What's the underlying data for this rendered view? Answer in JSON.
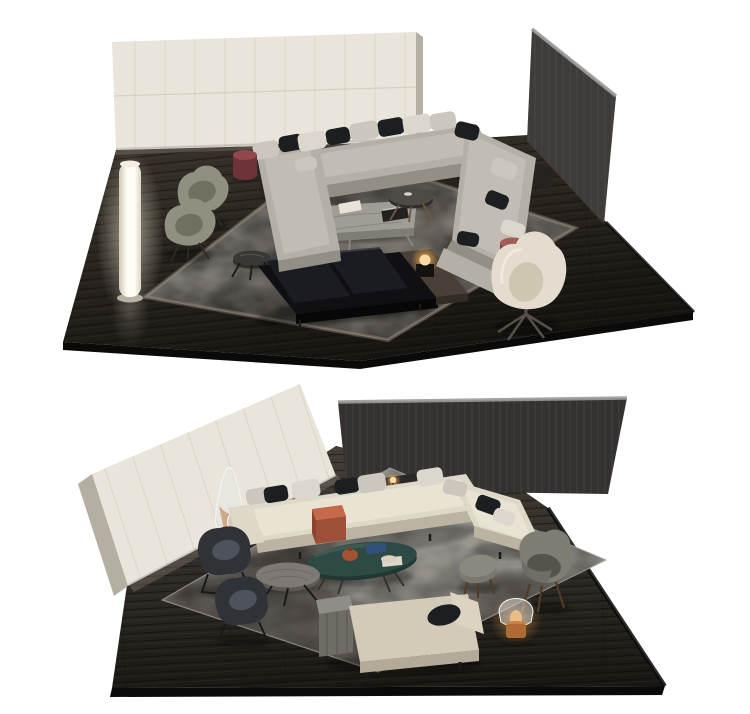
{
  "image": {
    "kind": "furniture-showroom-3d-render",
    "description": "Two isometric living-room scene renders stacked vertically on a white background, each on a dark oak platform floor with wall panels, sectional sofa, rug, tables, chairs and lamps.",
    "scenes": [
      {
        "id": "scene-top",
        "objects": [
          "cream paneled wall",
          "dark oak wall panel",
          "dark oak platform floor",
          "mottled grey area rug",
          "grey u-shaped sectional sofa with light and black cushions",
          "dark insert console",
          "grey marble low coffee table",
          "round charcoal side table",
          "round black marble side table",
          "black leather daybed with wood shelf and glowing sphere lamp",
          "two sage-green swivel armchairs",
          "illuminated column floor lamp",
          "burgundy cylinder side table",
          "rose cylinder side table",
          "cream high-back swivel armchair"
        ]
      },
      {
        "id": "scene-bottom",
        "objects": [
          "cream paneled wall",
          "dark oak wall panel",
          "dark oak platform floor",
          "mottled grey area rug",
          "cream sectional sofa with chaise and black cushions",
          "dark console with mini lamp",
          "rust clip-on side table",
          "teal oval coffee table with terracotta jar, bowl and blue book",
          "round grey wood coffee table",
          "two charcoal sled-base armchairs",
          "glass cone floor lamp with amber core",
          "grey lounge chair with wood legs",
          "grey ottoman",
          "glass dome table lamp with amber base",
          "beige chaise daybed with wood side shelf and black pillow"
        ]
      }
    ]
  },
  "palette": {
    "bg": "#ffffff",
    "floor1a": "#363028",
    "floor1b": "#161310",
    "floor2a": "#443f38",
    "floor2b": "#181512",
    "plankDark": "#0a0908",
    "plankLight": "#6b645a",
    "floorBevel": "#0b0a09",
    "wallCream": "#e9e5da",
    "wallCreamSeam": "#d3cec1",
    "wallCreamSide": "#b4afa2",
    "wallCreamShadow": "#8f887b",
    "wallDark1": "#3e3b38",
    "wallDark2": "#343130",
    "wallDarkBevel": "#9c9b99",
    "wallGrain": "#5a5754",
    "rug1a": "#6e6760",
    "rug1b": "#453f39",
    "rug1border": "#8d8478",
    "rug2a": "#9c9791",
    "rug2b": "#645f58",
    "rug2border": "#aaa59e",
    "rug2dark": "#37332e",
    "rug2light": "#bcb7af",
    "sofa1": "#b5b0a7",
    "sofa1Seat": "#c2bdb4",
    "sofa1Side": "#948f85",
    "sofa2": "#ded8c9",
    "sofa2Seat": "#e9e3d4",
    "sofa2Side": "#bcb4a2",
    "cushL": "#ccc7be",
    "cushL2": "#dcd7cd",
    "cushD": "#1d1e22",
    "console": "#262220",
    "console2": "#2b2826",
    "benchBase": "#101014",
    "benchCush": "#1b1c21",
    "benchCushHi": "#383b44",
    "woodShelf": "#4a4037",
    "woodShelfSide": "#342d26",
    "marbleTop": "#a09d97",
    "marbleVein": "#7b7872",
    "marbleSide": "#807d77",
    "darkRound": "#4e4a45",
    "darkRoundSide": "#2f2c29",
    "smallMarble": "#3a3835",
    "sage": "#8f9080",
    "sageInner": "#6f7060",
    "creamChair": "#e4ddcf",
    "creamChairIn": "#cfc6b2",
    "burgTop": "#91484c",
    "burgSide": "#6e3338",
    "roseTop": "#a65a58",
    "roseSide": "#7e4146",
    "lampEdge": "#cfc9ba",
    "lampCore": "#fffdf2",
    "lampBase": "#b7b1a3",
    "glowWhite": "#fff7e0",
    "glowAmber": "#ffb14d",
    "flame": "#f29a3a",
    "bulb": "#ffd9a6",
    "teal": "#2e4a45",
    "tealSide": "#203833",
    "grayRound2": "#7e7974",
    "grayRoundSide": "#5c5853",
    "darkChair": "#2f3237",
    "darkChairCush": "#4e525b",
    "grayChair": "#6f6d65",
    "grayChairBack": "#7e7c73",
    "grayChairSeat": "#55534c",
    "ottoman": "#7b786f",
    "ottomanTop": "#8b887e",
    "woodLeg": "#4e3b2a",
    "chaiseSeat": "#d3cbb8",
    "chaiseSide": "#b3ab98",
    "chaiseBack": "#dcd4c1",
    "chaiseWood": "#908d86",
    "chaiseWoodSide": "#6f6c66",
    "rust": "#c4694a",
    "rustSide": "#9d4f37",
    "terracotta": "#a4522f",
    "bowlCream": "#d9d0bd",
    "bookBlue": "#31507a",
    "bookDark": "#23211f",
    "trayWhite": "#e8e3d8",
    "bowlBlush": "#cfa184",
    "domeBase": "#b06a33",
    "amber": "#b66a28",
    "glass": "#e4e6e8",
    "glassEdge": "#f8f8fa",
    "legMetal": "#55504b",
    "legDark": "#1b1a18",
    "shadow": "#000000"
  }
}
